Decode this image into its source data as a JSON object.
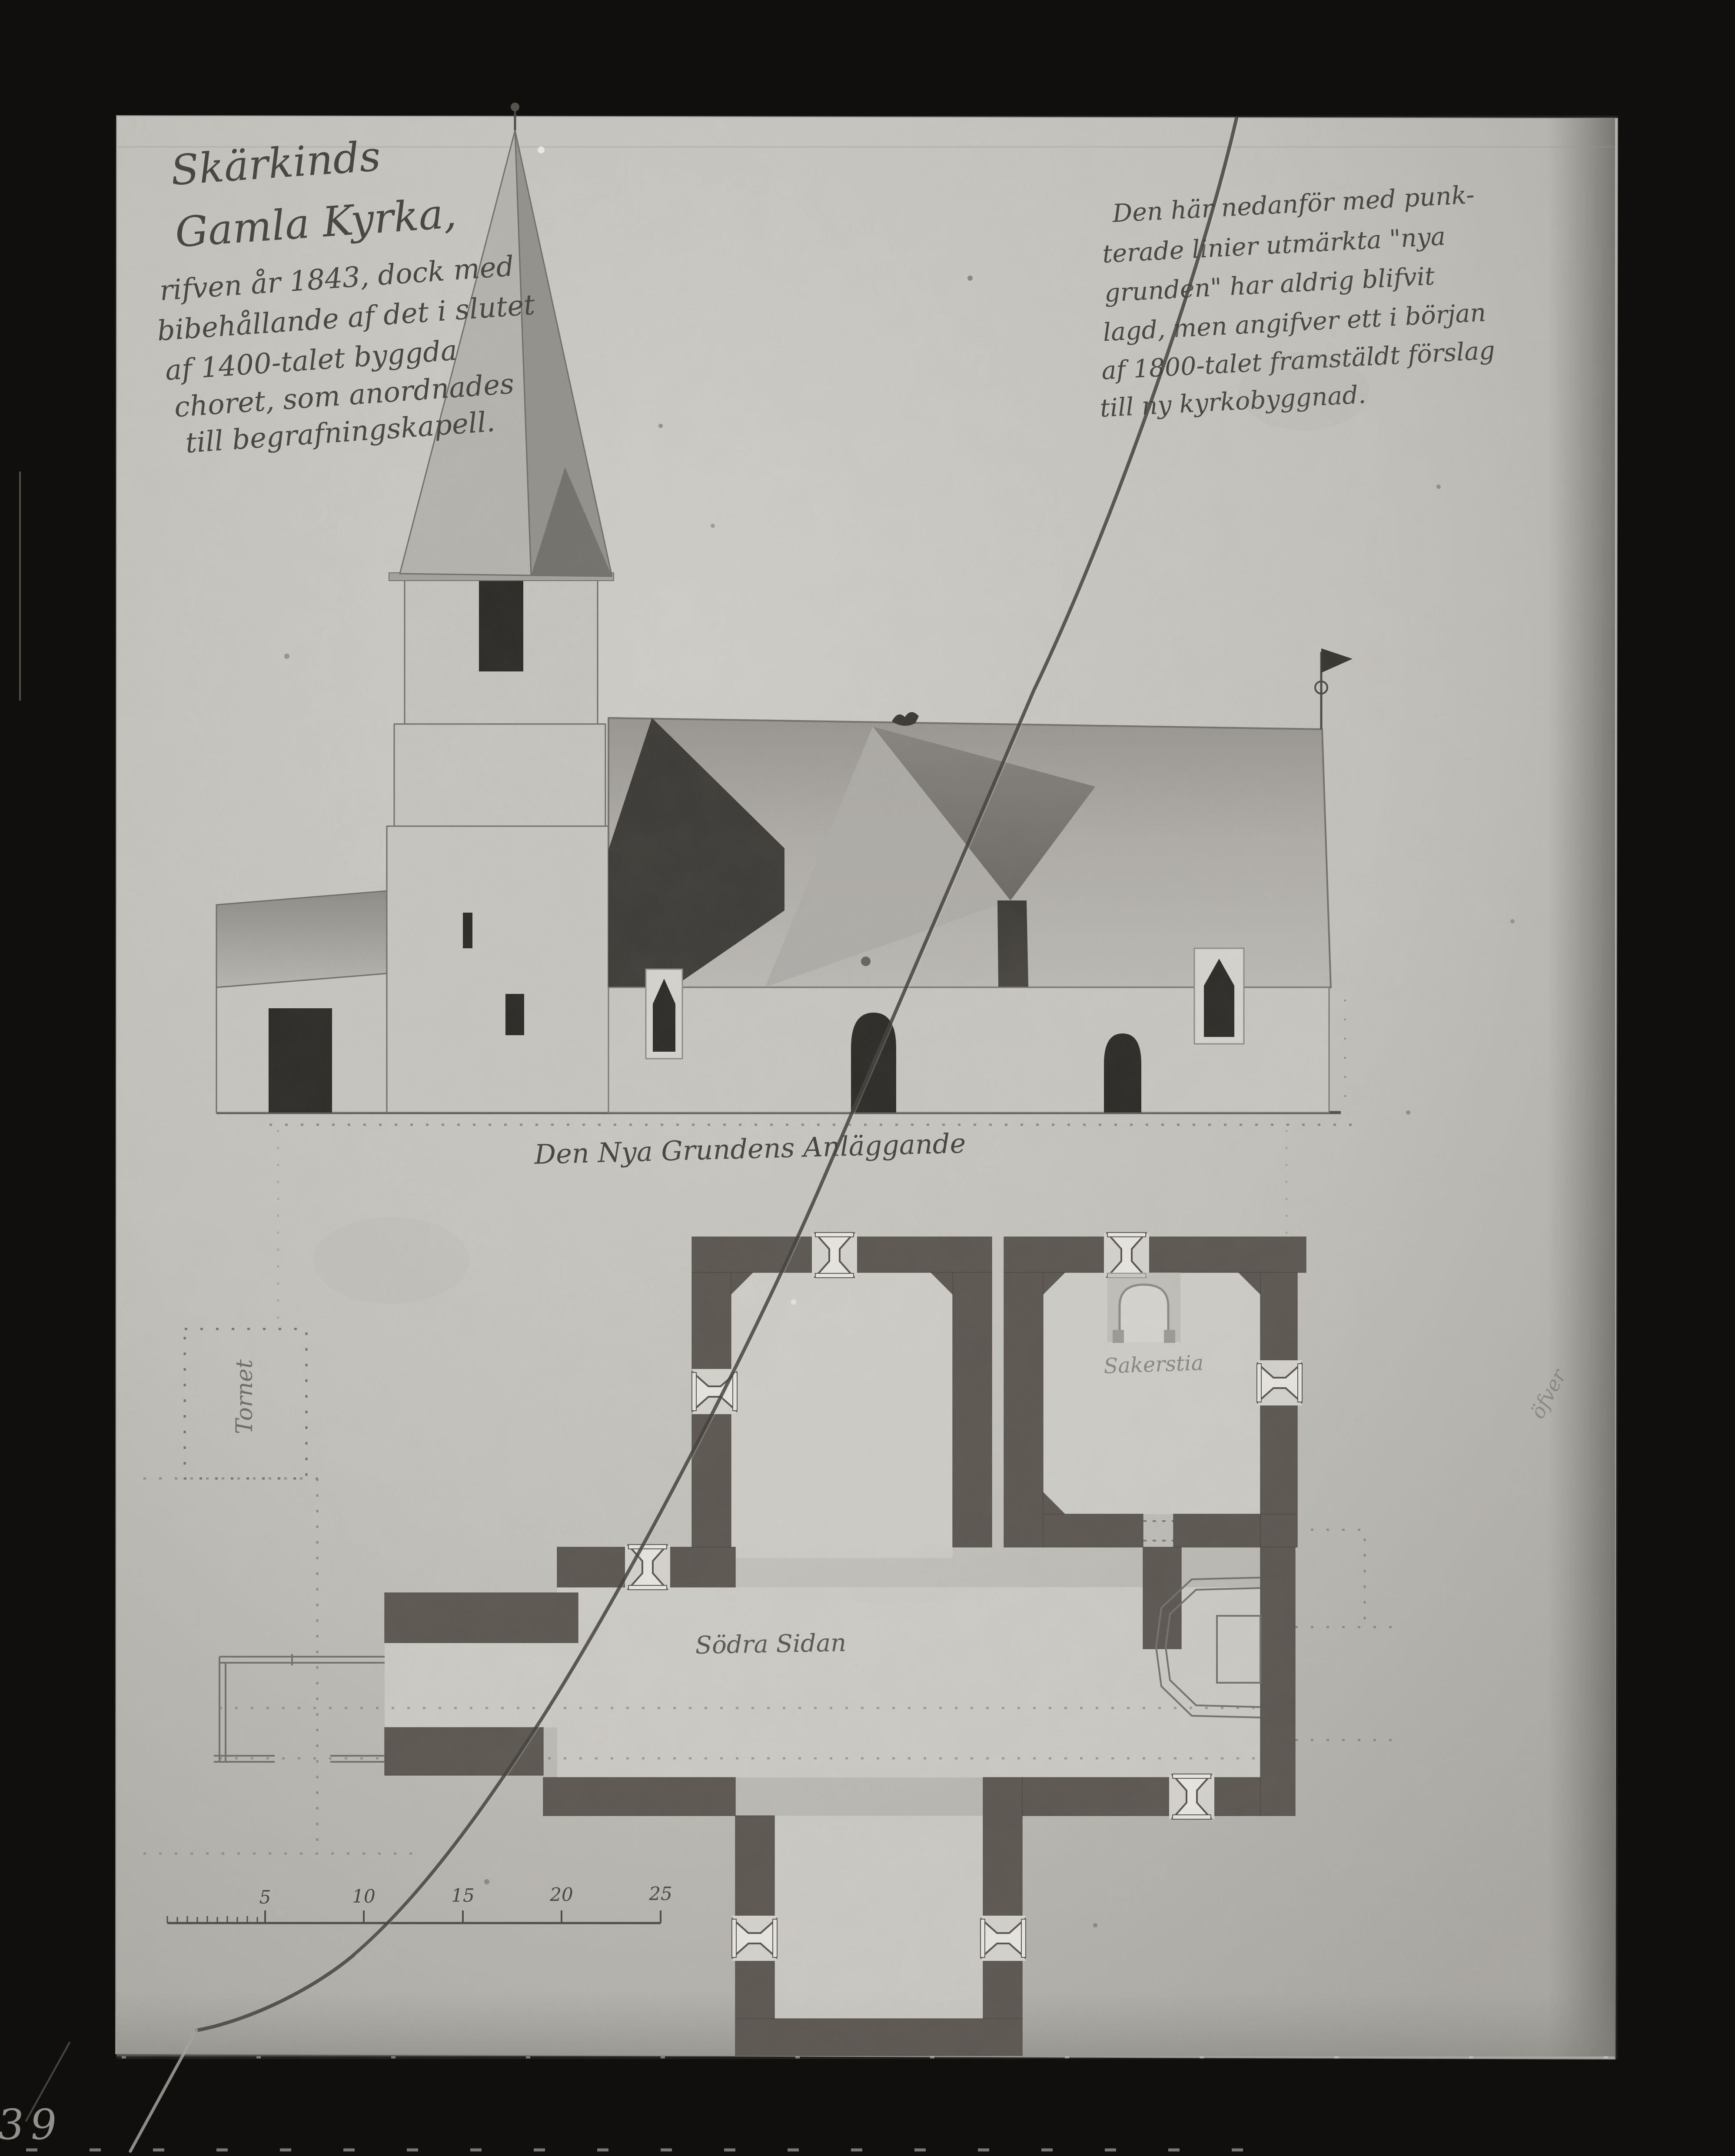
{
  "photo": {
    "type": "black-and-white photograph of an archival architectural drawing",
    "archive_number": "- 536ᵃ. 139",
    "margin_note": "öfver",
    "colors": {
      "frame": "#100f0e",
      "paper": "#c7c5c0",
      "ink": "#3e3c37",
      "plan_wall": "#55514a",
      "dark_opening": "#23221f"
    }
  },
  "annotations": {
    "title_block": {
      "lines": [
        "Skärkinds",
        "Gamla Kyrka,",
        "rifven år 1843, dock med",
        "bibehållande af det i slutet",
        "af 1400-talet byggda",
        "choret, som anordnades",
        "till begrafningskapell."
      ]
    },
    "note_block": {
      "lines": [
        "Den här nedanför med punk-",
        "terade linier utmärkta \"nya",
        "grunden\" har aldrig blifvit",
        "lagd, men angifver ett i början",
        "af 1800-talet framstäldt förslag",
        "till ny kyrkobyggnad."
      ]
    },
    "elevation_caption": "Den Nya Grundens Anläggande",
    "plan_labels": {
      "tower_footprint": "Tornet",
      "sacristy": "Sakerstia",
      "nave": "Södra Sidan"
    }
  },
  "scale_bar": {
    "ticks": [
      "5",
      "10",
      "15",
      "20",
      "25"
    ]
  }
}
